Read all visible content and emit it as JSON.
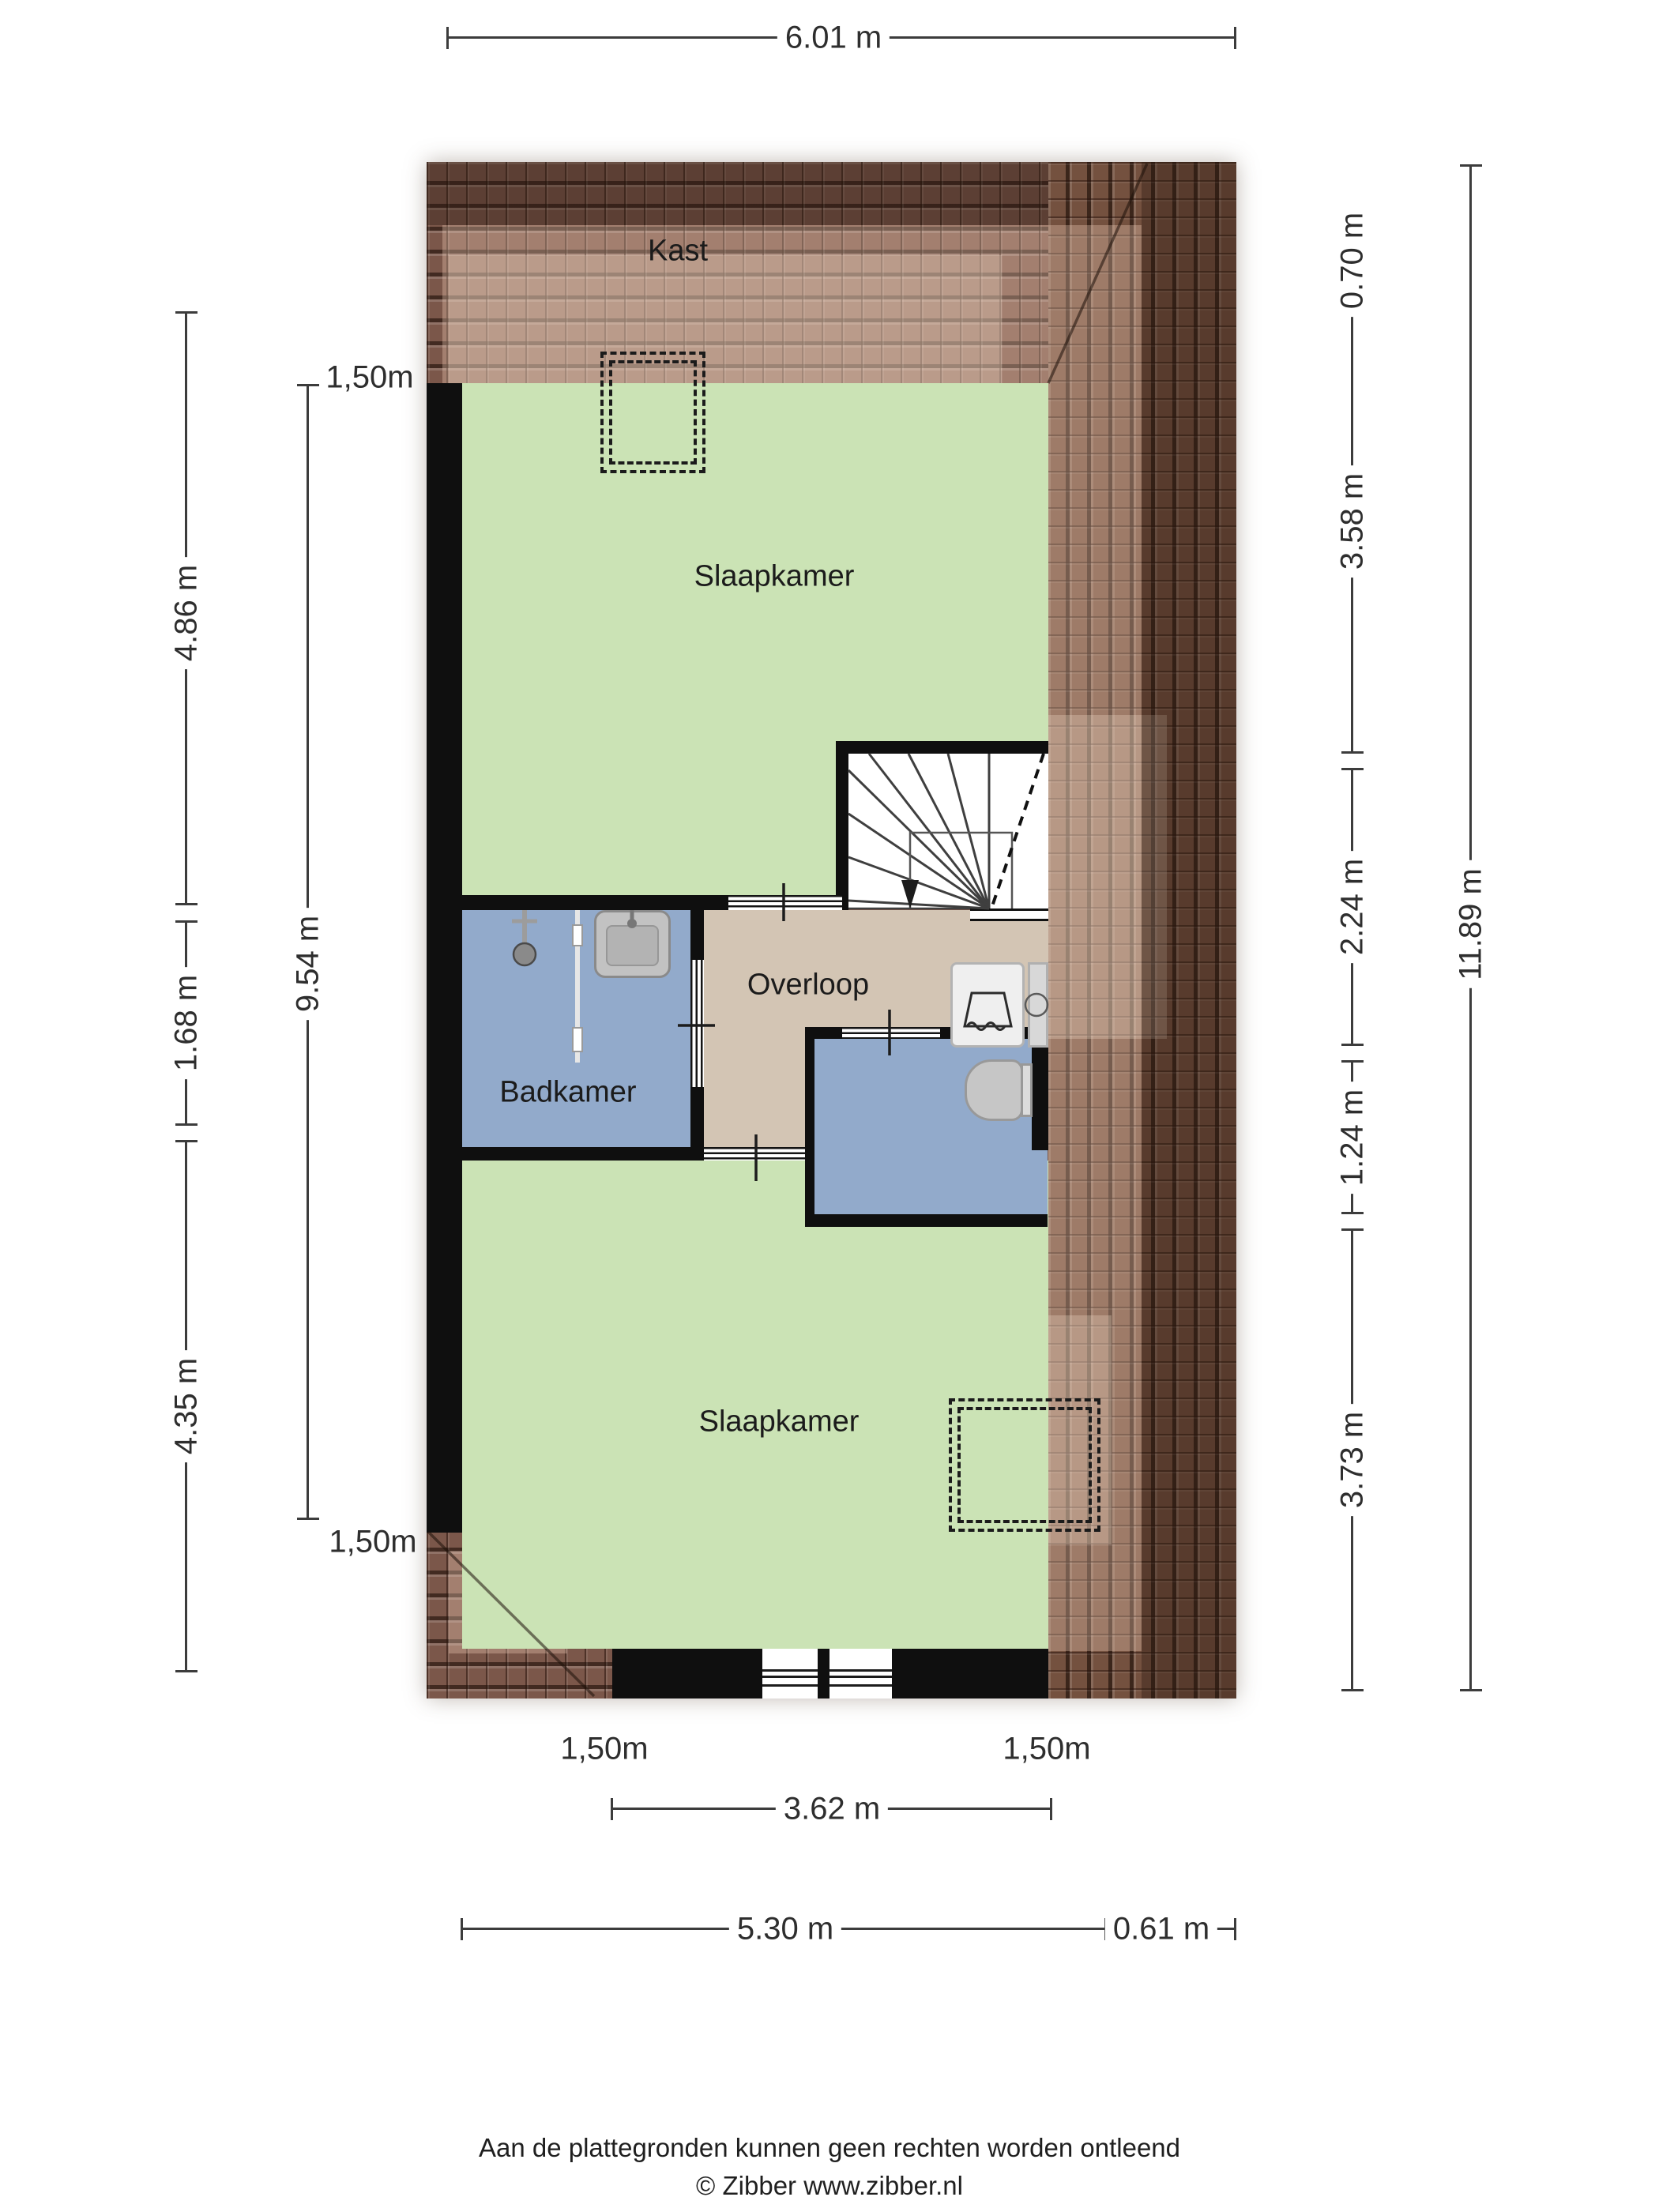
{
  "rooms": {
    "kast": "Kast",
    "slaapkamer_top": "Slaapkamer",
    "badkamer": "Badkamer",
    "overloop": "Overloop",
    "slaapkamer_bottom": "Slaapkamer"
  },
  "dims": {
    "top": "6.01 m",
    "left_outer": [
      "4.86 m",
      "1.68 m",
      "4.35 m"
    ],
    "left_inner_top": "1,50m",
    "left_inner": "9.54 m",
    "left_inner_bottom": "1,50m",
    "right_inner": [
      "0.70 m",
      "3.58 m",
      "2.24 m",
      "1.24 m",
      "3.73 m"
    ],
    "right_outer": "11.89 m",
    "clearance_left": "1,50m",
    "clearance_right": "1,50m",
    "bottom_inner": "3.62 m",
    "bottom_left": "5.30 m",
    "bottom_right": "0.61 m"
  },
  "footer": {
    "disclaimer": "Aan de plattegronden kunnen geen rechten worden ontleend",
    "credit": "© Zibber www.zibber.nl"
  },
  "colors": {
    "room_green": "#cbe3b5",
    "room_blue": "#92aacb",
    "room_tan": "#d3c5b4",
    "wall": "#0f0f0f",
    "roof_base": "#7b574a",
    "roof_dark": "#5f4337",
    "roof_light": "#9b7465",
    "dim_text": "#2e2e2e"
  }
}
